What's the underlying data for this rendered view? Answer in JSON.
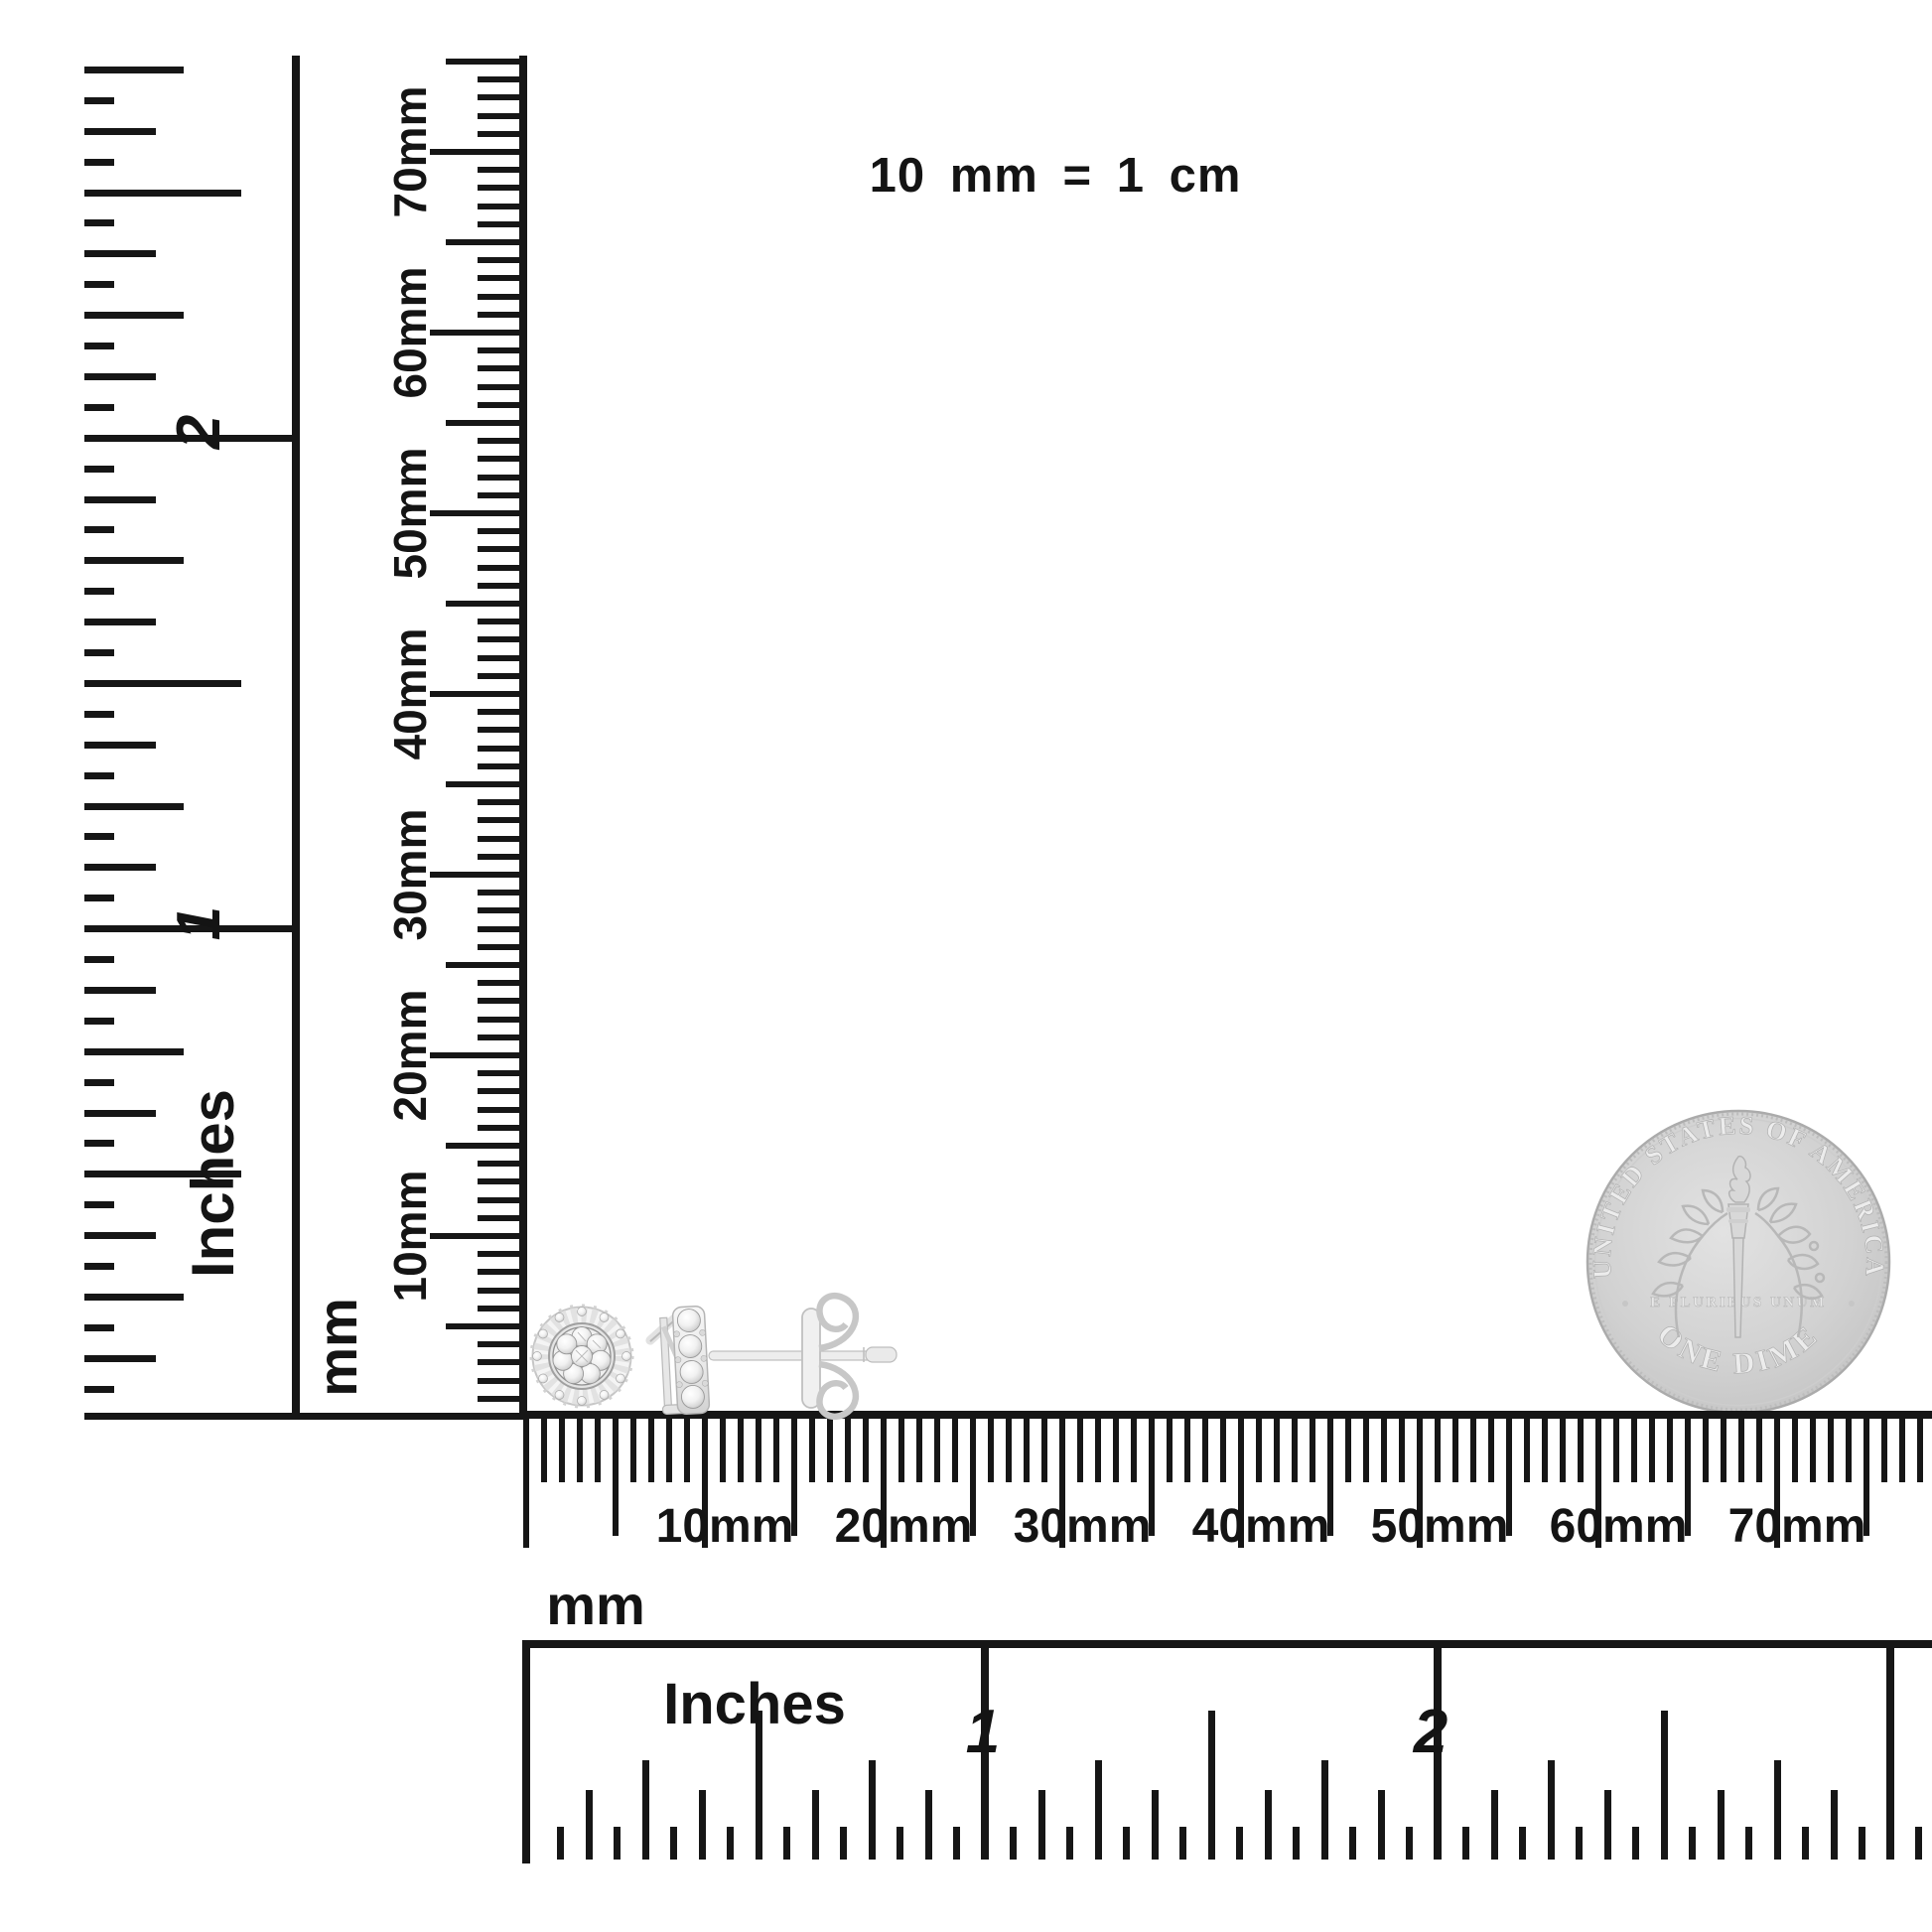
{
  "scale_note": "10 mm = 1 cm",
  "colors": {
    "background": "#ffffff",
    "ink": "#161616",
    "coin_body": "#d2d2d2",
    "coin_emboss": "#ececec",
    "metal": "#efefef",
    "metal_edge": "#bdbdbd"
  },
  "rulers": {
    "vertical_inches": {
      "unit_label": "Inches",
      "inch_labels": [
        "1",
        "2"
      ]
    },
    "vertical_mm": {
      "unit_label": "mm",
      "labels": [
        "10mm",
        "20mm",
        "30mm",
        "40mm",
        "50mm",
        "60mm",
        "70mm"
      ]
    },
    "horizontal_mm": {
      "unit_label": "mm",
      "labels": [
        "10mm",
        "20mm",
        "30mm",
        "40mm",
        "50mm",
        "60mm",
        "70mm"
      ]
    },
    "horizontal_inches": {
      "unit_label": "Inches",
      "inch_labels": [
        "1",
        "2"
      ]
    }
  },
  "coin": {
    "name": "US dime reverse",
    "top_text": "UNITED STATES OF AMERICA",
    "middle_text": "E PLURIBUS UNUM",
    "bottom_text": "ONE DIME"
  },
  "earrings": {
    "name": "diamond cluster stud earrings",
    "views": [
      "front view round cluster stud",
      "side view stud with post and butterfly back"
    ]
  }
}
